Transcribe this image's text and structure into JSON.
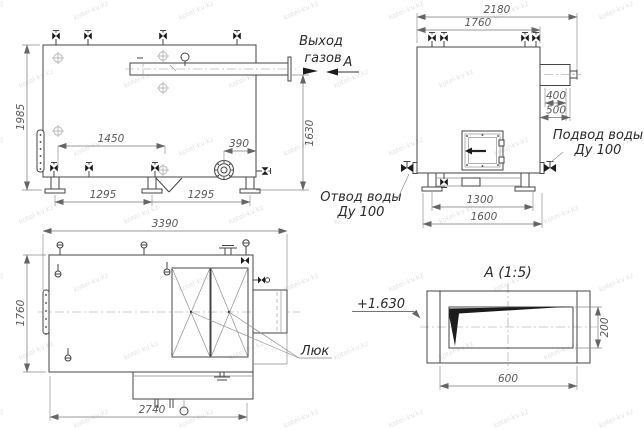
{
  "watermark": {
    "text": "kotel-kv.kz"
  },
  "annotations": {
    "gas_outlet_line1": "Выход",
    "gas_outlet_line2": "газов",
    "section_letter": "А"
  },
  "side_view": {
    "dim_height": "1985",
    "dim_flue_height": "1630",
    "dim_top_span": "1450",
    "dim_burner_offset": "390",
    "dim_support_span_left": "1295",
    "dim_support_span_right": "1295"
  },
  "end_view": {
    "dim_overall_width": "2180",
    "dim_body_width": "1760",
    "dim_duct_width": "400",
    "dim_duct_span": "500",
    "dim_base_inner": "1300",
    "dim_base_outer": "1600",
    "label_water_supply_line1": "Подвод воды",
    "label_water_supply_line2": "Ду 100",
    "label_water_return_line1": "Отвод воды",
    "label_water_return_line2": "Ду 100"
  },
  "plan_view": {
    "dim_length": "3390",
    "dim_width": "1760",
    "dim_base_length": "2740",
    "label_hatch": "Люк"
  },
  "detail_view": {
    "title": "А  (1:5)",
    "elevation_mark": "+1.630",
    "dim_height": "200",
    "dim_width": "600"
  }
}
